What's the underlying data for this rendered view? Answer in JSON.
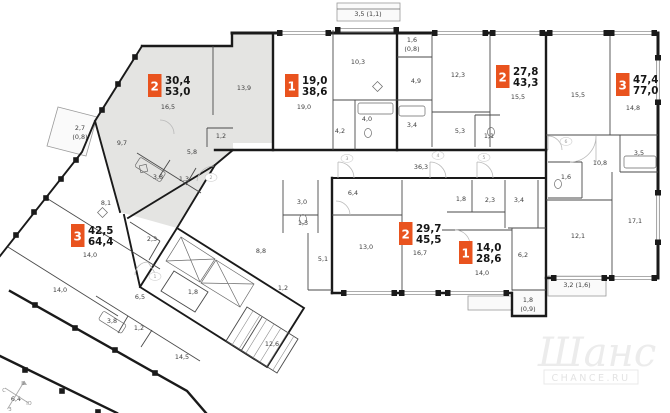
{
  "watermark": {
    "logo": "Шанс",
    "domain": "CHANCE.RU"
  },
  "colors": {
    "badge": "#e9531e",
    "selected_fill": "#e4e4e2",
    "wall": "#1a1a1a"
  },
  "apartments": [
    {
      "id": "apt-2room-selected",
      "rooms_count": "2",
      "living_area": "30,4",
      "total_area": "53,0",
      "selected": true
    },
    {
      "id": "apt-1room-top",
      "rooms_count": "1",
      "living_area": "19,0",
      "total_area": "38,6",
      "selected": false
    },
    {
      "id": "apt-2room-top",
      "rooms_count": "2",
      "living_area": "27,8",
      "total_area": "43,3",
      "selected": false
    },
    {
      "id": "apt-3room-right",
      "rooms_count": "3",
      "living_area": "47,4",
      "total_area": "77,0",
      "selected": false
    },
    {
      "id": "apt-2room-bottom",
      "rooms_count": "2",
      "living_area": "29,7",
      "total_area": "45,5",
      "selected": false
    },
    {
      "id": "apt-1room-bottom",
      "rooms_count": "1",
      "living_area": "14,0",
      "total_area": "28,6",
      "selected": false
    },
    {
      "id": "apt-3room-left",
      "rooms_count": "3",
      "living_area": "42,5",
      "total_area": "64,4",
      "selected": false
    }
  ],
  "room_labels": [
    {
      "t": "16,5",
      "x": 168,
      "y": 109
    },
    {
      "t": "13,9",
      "x": 244,
      "y": 90
    },
    {
      "t": "9,7",
      "x": 122,
      "y": 145
    },
    {
      "t": "5,8",
      "x": 192,
      "y": 154
    },
    {
      "t": "3,8",
      "x": 158,
      "y": 179
    },
    {
      "t": "1,3",
      "x": 184,
      "y": 181
    },
    {
      "t": "1,2",
      "x": 221,
      "y": 138
    },
    {
      "t": "2,7",
      "x": 80,
      "y": 130
    },
    {
      "t": "(0,8)",
      "x": 80,
      "y": 139
    },
    {
      "t": "19,0",
      "x": 304,
      "y": 109
    },
    {
      "t": "10,3",
      "x": 358,
      "y": 64
    },
    {
      "t": "3,5 (1,1)",
      "x": 368,
      "y": 16
    },
    {
      "t": "1,6",
      "x": 412,
      "y": 42
    },
    {
      "t": "(0,8)",
      "x": 412,
      "y": 51
    },
    {
      "t": "4,9",
      "x": 416,
      "y": 83
    },
    {
      "t": "4,0",
      "x": 367,
      "y": 121
    },
    {
      "t": "4,2",
      "x": 340,
      "y": 133
    },
    {
      "t": "3,4",
      "x": 412,
      "y": 127
    },
    {
      "t": "12,3",
      "x": 458,
      "y": 77
    },
    {
      "t": "5,3",
      "x": 460,
      "y": 133
    },
    {
      "t": "1,1",
      "x": 489,
      "y": 138
    },
    {
      "t": "15,5",
      "x": 518,
      "y": 99
    },
    {
      "t": "15,5",
      "x": 578,
      "y": 97
    },
    {
      "t": "14,8",
      "x": 633,
      "y": 110
    },
    {
      "t": "10,8",
      "x": 600,
      "y": 165
    },
    {
      "t": "3,5",
      "x": 639,
      "y": 155
    },
    {
      "t": "1,6",
      "x": 566,
      "y": 179
    },
    {
      "t": "17,1",
      "x": 635,
      "y": 223
    },
    {
      "t": "12,1",
      "x": 578,
      "y": 238
    },
    {
      "t": "3,2 (1,6)",
      "x": 577,
      "y": 287
    },
    {
      "t": "36,3",
      "x": 421,
      "y": 169
    },
    {
      "t": "6,4",
      "x": 353,
      "y": 195
    },
    {
      "t": "13,0",
      "x": 366,
      "y": 249
    },
    {
      "t": "16,7",
      "x": 420,
      "y": 255
    },
    {
      "t": "3,0",
      "x": 302,
      "y": 204
    },
    {
      "t": "1,3",
      "x": 303,
      "y": 225
    },
    {
      "t": "5,1",
      "x": 323,
      "y": 261
    },
    {
      "t": "1,8",
      "x": 461,
      "y": 201
    },
    {
      "t": "2,3",
      "x": 490,
      "y": 202
    },
    {
      "t": "3,4",
      "x": 519,
      "y": 202
    },
    {
      "t": "14,0",
      "x": 482,
      "y": 275
    },
    {
      "t": "6,2",
      "x": 523,
      "y": 257
    },
    {
      "t": "1,8",
      "x": 528,
      "y": 302
    },
    {
      "t": "(0,9)",
      "x": 528,
      "y": 311
    },
    {
      "t": "8,8",
      "x": 261,
      "y": 253
    },
    {
      "t": "1,2",
      "x": 283,
      "y": 290
    },
    {
      "t": "1,8",
      "x": 193,
      "y": 294
    },
    {
      "t": "12,6",
      "x": 272,
      "y": 346
    },
    {
      "t": "8,1",
      "x": 106,
      "y": 205
    },
    {
      "t": "2,3",
      "x": 152,
      "y": 241
    },
    {
      "t": "14,0",
      "x": 90,
      "y": 257
    },
    {
      "t": "14,0",
      "x": 60,
      "y": 292
    },
    {
      "t": "6,5",
      "x": 140,
      "y": 299
    },
    {
      "t": "3,8",
      "x": 112,
      "y": 323
    },
    {
      "t": "1,2",
      "x": 139,
      "y": 330
    },
    {
      "t": "14,5",
      "x": 182,
      "y": 359
    },
    {
      "t": "6,4",
      "x": 16,
      "y": 401
    }
  ],
  "door_numbers": [
    {
      "t": "1",
      "x": 155,
      "y": 278
    },
    {
      "t": "2",
      "x": 211,
      "y": 179
    },
    {
      "t": "3",
      "x": 347,
      "y": 160
    },
    {
      "t": "4",
      "x": 438,
      "y": 157
    },
    {
      "t": "5",
      "x": 484,
      "y": 159
    },
    {
      "t": "6",
      "x": 566,
      "y": 143
    }
  ],
  "compass": {
    "letters": [
      {
        "t": "С",
        "x": 4,
        "y": 392
      },
      {
        "t": "В",
        "x": 23,
        "y": 385
      },
      {
        "t": "Ю",
        "x": 29,
        "y": 405
      },
      {
        "t": "З",
        "x": 10,
        "y": 411
      }
    ]
  }
}
